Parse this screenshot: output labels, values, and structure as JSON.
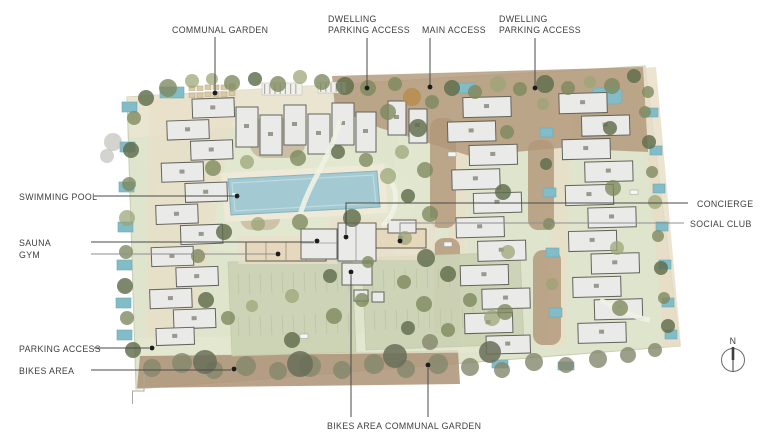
{
  "figure": {
    "type": "architectural-site-plan",
    "palette": {
      "parcel_green": "#dfe4cc",
      "parking_green": "#ccd3b5",
      "mulch_brown": "#b2977a",
      "paving_beige": "#eadfc8",
      "pool_water": "#a3cad2",
      "small_pool_water": "#82bcc7",
      "building_white": "#eaeae8",
      "building_beige": "#e6d8bd",
      "tree_olive": "#7c885c",
      "label_text": "#3e3e3e",
      "leader_line": "#4a4a4a"
    }
  },
  "labels": {
    "communal_garden_top": "COMMUNAL GARDEN",
    "dwelling_parking_access_left": {
      "line1": "DWELLING",
      "line2": "PARKING ACCESS"
    },
    "main_access": "MAIN ACCESS",
    "dwelling_parking_access_right": {
      "line1": "DWELLING",
      "line2": "PARKING ACCESS"
    },
    "swimming_pool": "SWIMMING POOL",
    "sauna": "SAUNA",
    "gym": "GYM",
    "concierge": "CONCIERGE",
    "social_club": "SOCIAL CLUB",
    "parking_access": "PARKING ACCESS",
    "bikes_area_left": "BIKES AREA",
    "bikes_area_bottom": "BIKES AREA",
    "communal_garden_bottom": "COMMUNAL GARDEN",
    "north": "N"
  }
}
